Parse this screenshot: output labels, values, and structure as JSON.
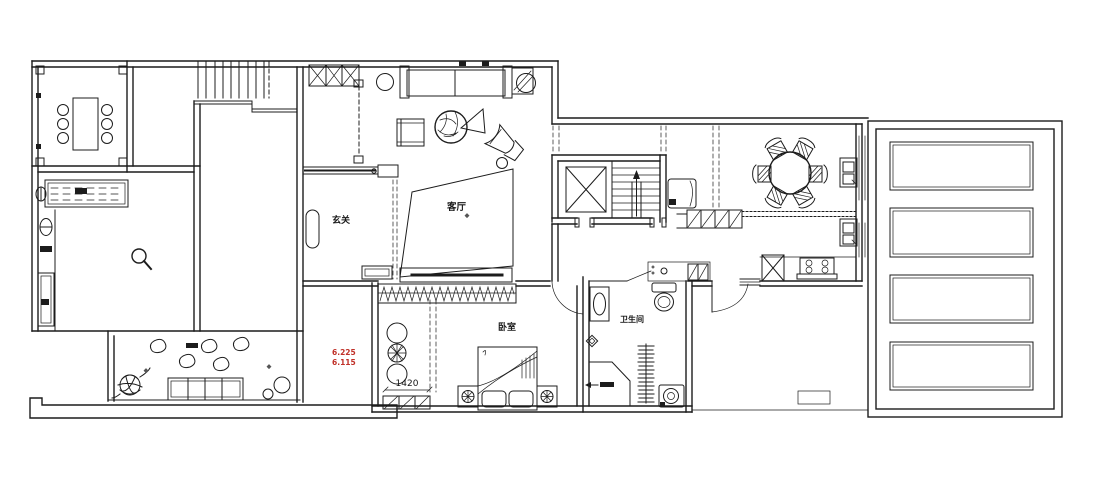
{
  "colors": {
    "background": "#ffffff",
    "linework": "#1c1c1c",
    "annotation_red": "#c03028"
  },
  "rooms": [
    {
      "id": "foyer",
      "label": "玄关"
    },
    {
      "id": "living-room",
      "label": "客厅"
    },
    {
      "id": "bedroom",
      "label": "卧室"
    },
    {
      "id": "bathroom",
      "label": "卫生间"
    }
  ],
  "annotations": {
    "wardrobe_dimension": "1420",
    "elevation_upper": "6.225",
    "elevation_lower": "6.115"
  }
}
